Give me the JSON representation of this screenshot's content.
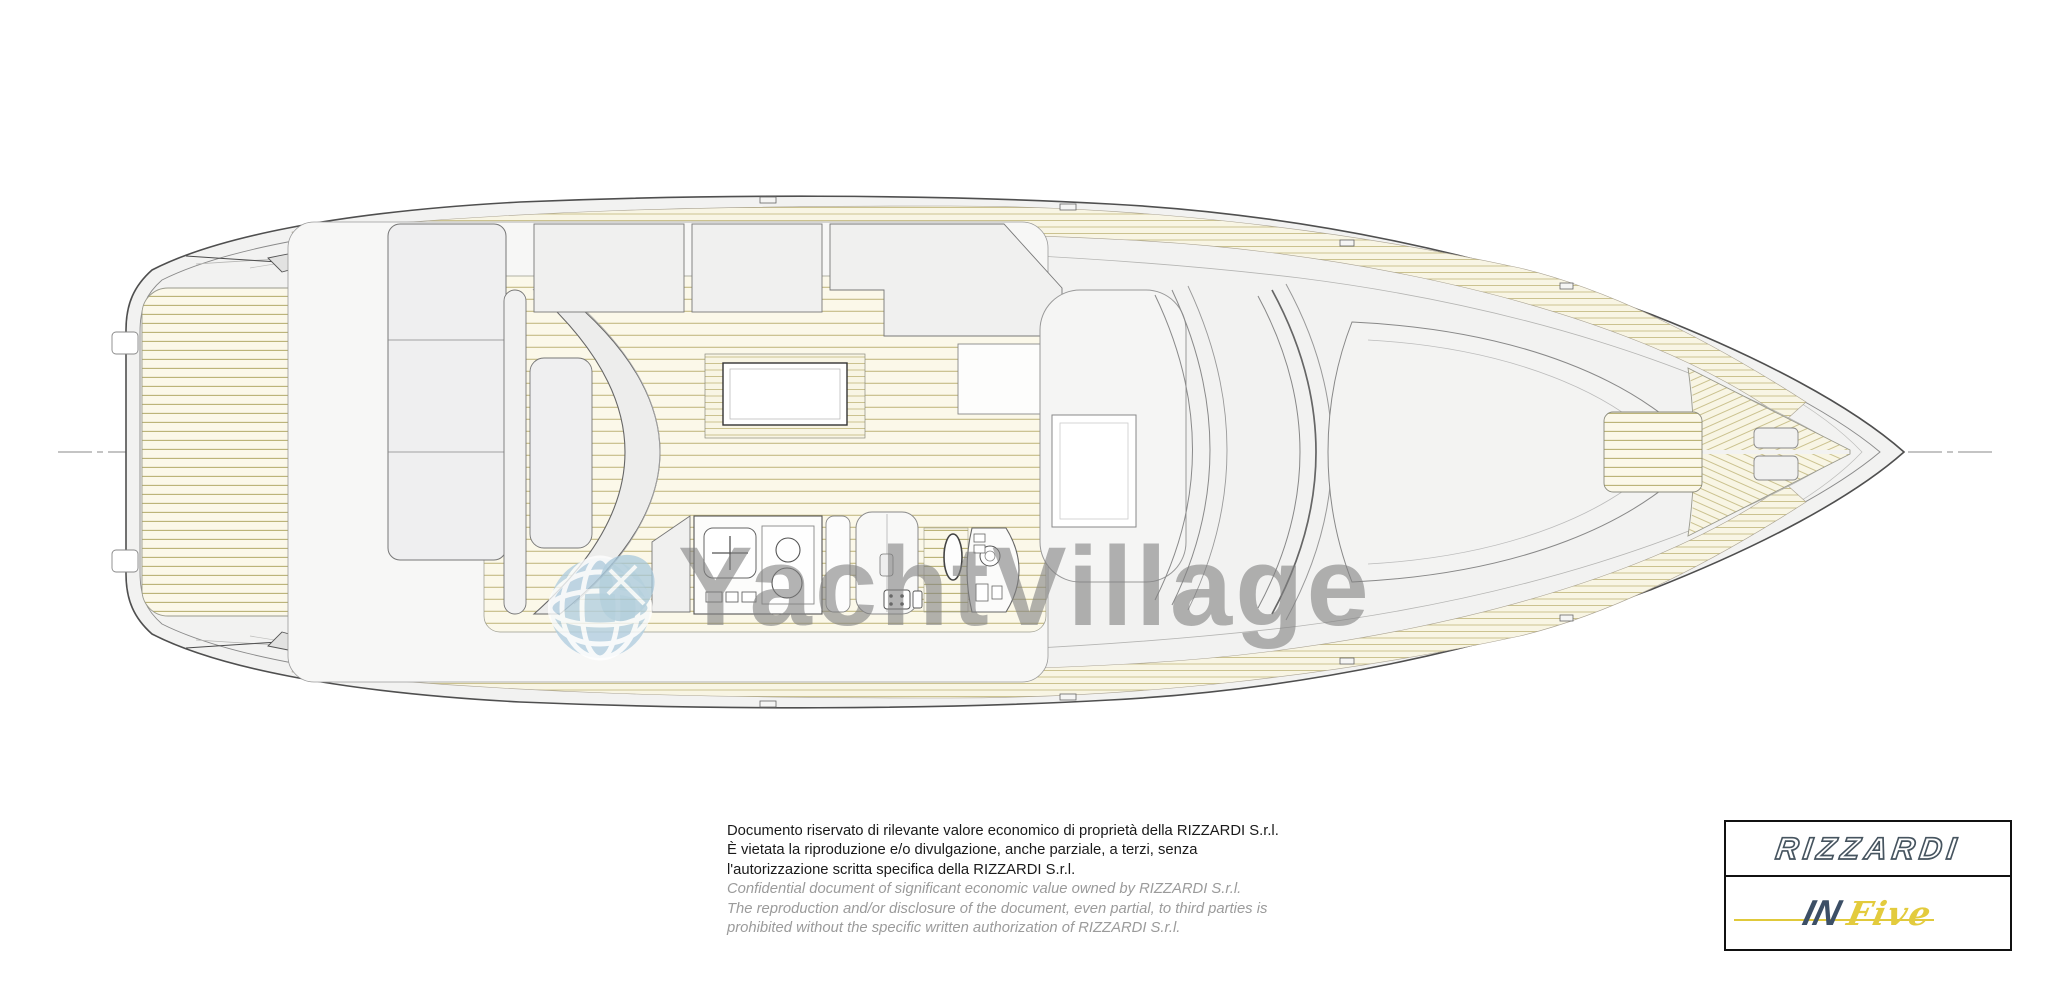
{
  "watermark": {
    "text": "YachtVillage",
    "text_color": "#808080",
    "globe_color": "#b3cfe0"
  },
  "drawing": {
    "subject": "yacht-deck-plan-top-view",
    "hull_fill": "#f2f2f1",
    "outline_color": "#4f4f4f",
    "teak_bg_color": "#fbf8e9",
    "teak_line_color": "#b9b173",
    "furniture_fill": "#efefef",
    "centerline_color": "#8a8a8a"
  },
  "disclaimer": {
    "italian": [
      "Documento riservato di rilevante valore economico di proprietà della RIZZARDI S.r.l.",
      "È vietata la riproduzione e/o divulgazione, anche parziale, a terzi, senza",
      "l'autorizzazione scritta specifica della RIZZARDI S.r.l."
    ],
    "english": [
      "Confidential document of significant economic value owned by RIZZARDI S.r.l.",
      "The reproduction and/or disclosure of the document, even partial, to third parties is",
      "prohibited without the specific written authorization of RIZZARDI S.r.l."
    ],
    "italian_color": "#1a1a1a",
    "english_color": "#9b9b9b"
  },
  "logo_box": {
    "brand": "RIZZARDI",
    "model_prefix": "IN",
    "model_name": "Five",
    "brand_color": "#46545f",
    "prefix_color": "#3c4f66",
    "model_color": "#e3cb3d",
    "border_color": "#111111"
  }
}
